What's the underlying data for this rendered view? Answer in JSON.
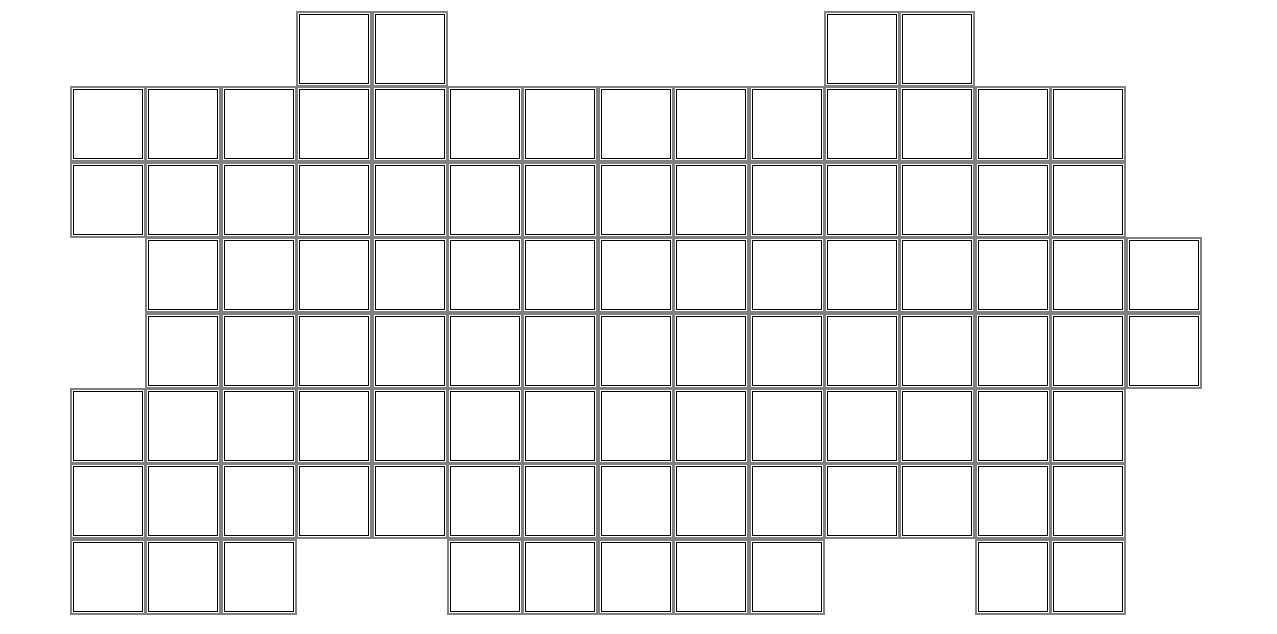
{
  "board": {
    "description": "empty irregular puzzle board of square cells",
    "rows": 8,
    "max_cols": 15,
    "total_cells": 98,
    "origin_x": 73,
    "origin_y": 14,
    "cell_pitch": 75.4,
    "cell_inner_size": 68,
    "row_cells": [
      [
        3,
        4,
        10,
        11
      ],
      [
        0,
        1,
        2,
        3,
        4,
        5,
        6,
        7,
        8,
        9,
        10,
        11,
        12,
        13
      ],
      [
        0,
        1,
        2,
        3,
        4,
        5,
        6,
        7,
        8,
        9,
        10,
        11,
        12,
        13
      ],
      [
        1,
        2,
        3,
        4,
        5,
        6,
        7,
        8,
        9,
        10,
        11,
        12,
        13,
        14
      ],
      [
        1,
        2,
        3,
        4,
        5,
        6,
        7,
        8,
        9,
        10,
        11,
        12,
        13,
        14
      ],
      [
        0,
        1,
        2,
        3,
        4,
        5,
        6,
        7,
        8,
        9,
        10,
        11,
        12,
        13
      ],
      [
        0,
        1,
        2,
        3,
        4,
        5,
        6,
        7,
        8,
        9,
        10,
        11,
        12,
        13
      ],
      [
        0,
        1,
        2,
        5,
        6,
        7,
        8,
        9,
        12,
        13
      ]
    ],
    "colors": {
      "page_background": "#ffffff",
      "cell_fill": "#ffffff",
      "cell_border": "#000000",
      "cell_outline": "#808080"
    }
  }
}
